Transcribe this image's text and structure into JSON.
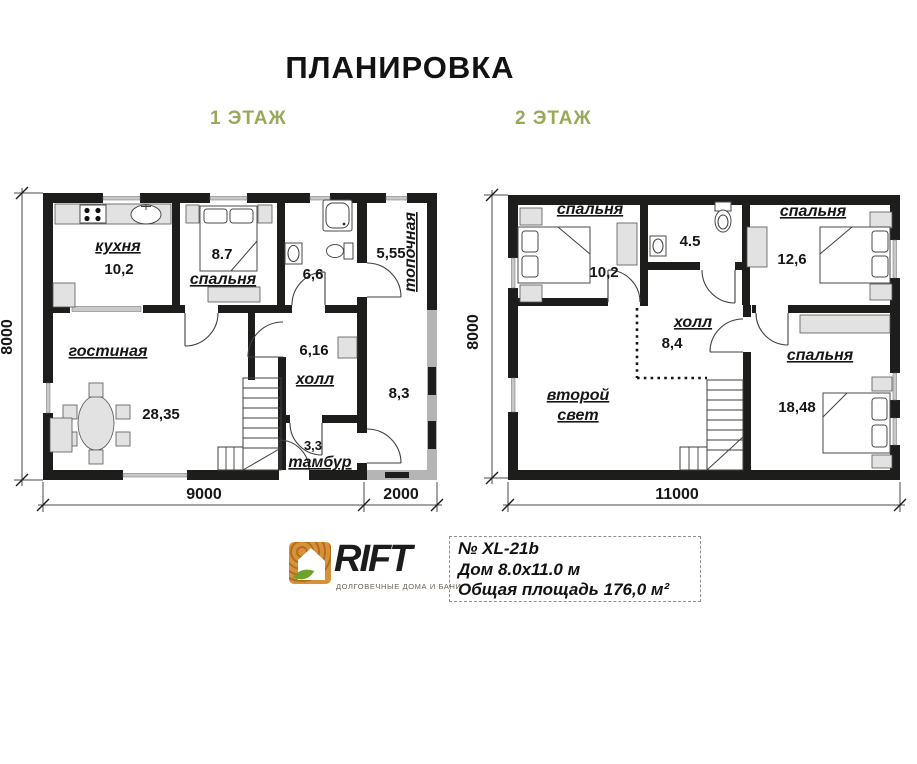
{
  "title": "ПЛАНИРОВКА",
  "floor1": {
    "label": "1 ЭТАЖ",
    "rooms": {
      "kitchen": {
        "name": "кухня",
        "area": "10,2"
      },
      "bedroom": {
        "name": "спальня",
        "area": "8.7"
      },
      "bathroom": {
        "area": "6,6"
      },
      "boiler": {
        "name": "топочная",
        "area": "5,55"
      },
      "living": {
        "name": "гостиная",
        "area": "28,35"
      },
      "hall": {
        "name": "холл",
        "area": "6,16"
      },
      "tambour": {
        "name": "тамбур",
        "area": "3,3"
      },
      "side_room": {
        "area": "8,3"
      }
    },
    "dims": {
      "left": "8000",
      "bottom_main": "9000",
      "bottom_side": "2000"
    }
  },
  "floor2": {
    "label": "2 ЭТАЖ",
    "rooms": {
      "bedroom1": {
        "name": "спальня",
        "area": "10,2"
      },
      "bathroom": {
        "area": "4.5"
      },
      "bedroom2": {
        "name": "спальня",
        "area": "12,6"
      },
      "hall": {
        "name": "холл",
        "area": "8,4"
      },
      "void": {
        "line1": "второй",
        "line2": "свет"
      },
      "bedroom3": {
        "name": "спальня",
        "area": "18,48"
      }
    },
    "dims": {
      "left": "8000",
      "bottom": "11000"
    }
  },
  "footer": {
    "brand": "RIFT",
    "tagline": "ДОЛГОВЕЧНЫЕ ДОМА И БАНИ",
    "plan_number": "№ XL-21b",
    "house_size": "Дом 8.0х11.0 м",
    "total_area": "Общая площадь 176,0 м²"
  },
  "icons": [
    "stove-icon",
    "kitchen-sink-icon",
    "bath-sink-icon",
    "shower-icon",
    "toilet-icon",
    "bed-icon",
    "dining-table-icon",
    "chair-icon",
    "stairs-icon",
    "wardrobe-icon",
    "door-arc",
    "window",
    "railing-dotted",
    "logo-icon"
  ],
  "colors": {
    "wall": "#1d1d1b",
    "porch_wall": "#b5b5b5",
    "accent_green": "#97a95a",
    "furniture": "#e2e2e2",
    "window_sill": "#c9c9c9",
    "logo_orange": "#d8903a",
    "logo_leaf": "#6da32c"
  }
}
